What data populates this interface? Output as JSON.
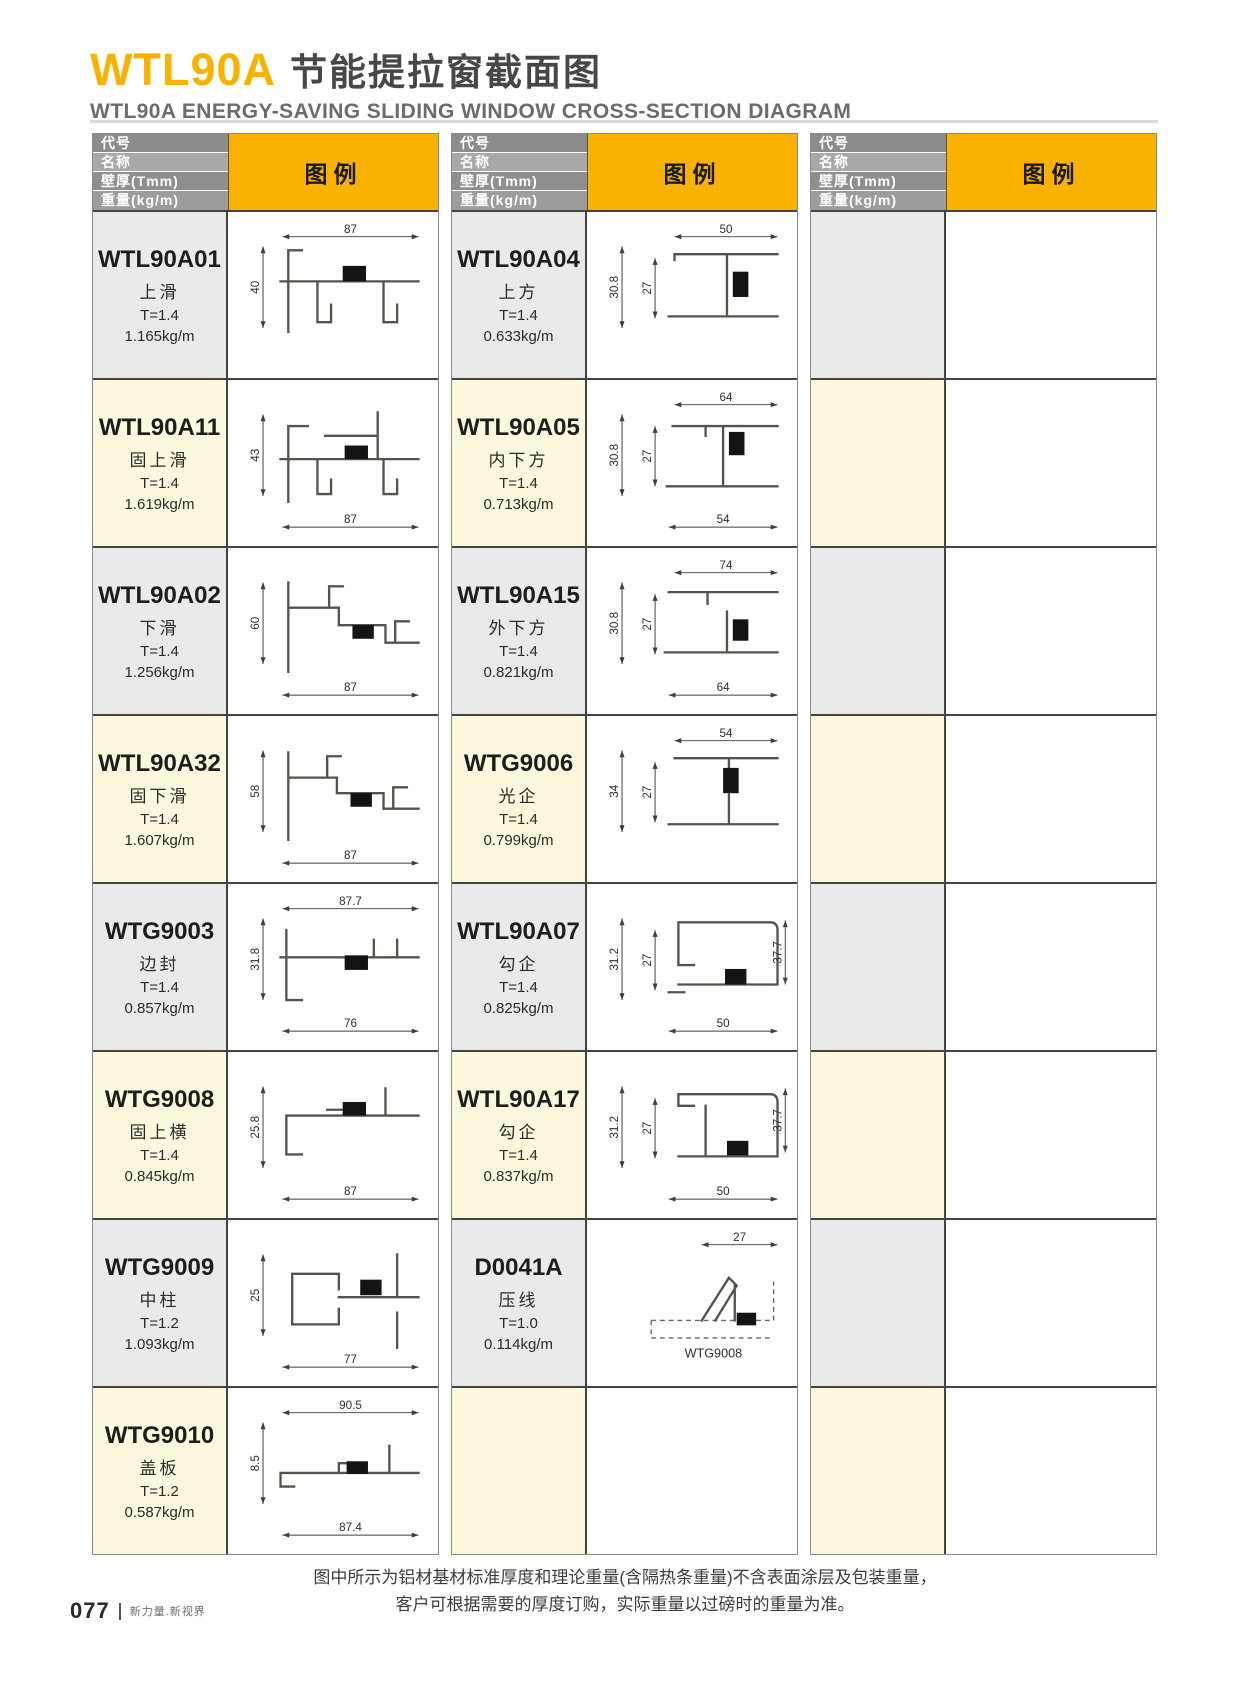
{
  "page": {
    "title_code": "WTL90A",
    "title_cn": "节能提拉窗截面图",
    "subtitle": "WTL90A ENERGY-SAVING SLIDING WINDOW CROSS-SECTION DIAGRAM",
    "footer_note_line1": "图中所示为铝材基材标准厚度和理论重量(含隔热条重量)不含表面涂层及包装重量，",
    "footer_note_line2": "客户可根据需要的厚度订购，实际重量以过磅时的重量为准。",
    "page_number": "077",
    "page_tagline": "新力量.新视界"
  },
  "colors": {
    "accent": "#F9B200",
    "header_grays": [
      "#8C8C8C",
      "#A8A8A8",
      "#8F8F8F",
      "#9C9C9C"
    ],
    "row_gray": "#EAEAEB",
    "row_cream": "#FBF8DD"
  },
  "table_header": {
    "labels": [
      "代号",
      "名称",
      "壁厚(Tmm)",
      "重量(kg/m)"
    ],
    "legend": "图例"
  },
  "tables": [
    {
      "rows": [
        {
          "code": "WTL90A01",
          "name": "上滑",
          "thickness": "T=1.4",
          "weight": "1.165kg/m",
          "diagram": {
            "top": "87",
            "left": "40",
            "sketch": "M60,36 h14 M60,36 v84 M52,68 h142 M90,68 v42 h14 v-18 M158,68 v42 h14 v-18",
            "block": [
              116,
              52,
              24,
              16
            ]
          }
        },
        {
          "code": "WTL90A11",
          "name": "固上滑",
          "thickness": "T=1.4",
          "weight": "1.619kg/m",
          "diagram": {
            "left": "43",
            "bottom": "87",
            "sketch": "M60,44 h20 M60,44 v78 M52,78 h142 M152,30 v48 M98,54 h54 M90,78 v36 h14 v-15 M158,78 v36 h14 v-15",
            "block": [
              118,
              64,
              24,
              14
            ]
          }
        },
        {
          "code": "WTL90A02",
          "name": "下滑",
          "thickness": "T=1.4",
          "weight": "1.256kg/m",
          "diagram": {
            "left": "60",
            "bottom": "87",
            "sketch": "M60,32 v92 M60,58 h52 v18 h48 v18 h34 M102,58 v-22 h14 M170,94 v-22 h14",
            "block": [
              126,
              76,
              22,
              14
            ]
          }
        },
        {
          "code": "WTL90A32",
          "name": "固下滑",
          "thickness": "T=1.4",
          "weight": "1.607kg/m",
          "diagram": {
            "left": "58",
            "bottom": "87",
            "sketch": "M60,34 v90 M60,60 h50 v16 h48 v16 h36 M100,60 v-22 h14 M168,92 v-22 h14",
            "block": [
              124,
              76,
              22,
              14
            ]
          }
        },
        {
          "code": "WTG9003",
          "name": "边封",
          "thickness": "T=1.4",
          "weight": "0.857kg/m",
          "diagram": {
            "top": "87.7",
            "left": "31.8",
            "bottom": "76",
            "sketch": "M58,44 v72 h16 M52,72 h142 M148,72 v-18 M172,72 v-18",
            "block": [
              118,
              70,
              24,
              15
            ]
          }
        },
        {
          "code": "WTG9008",
          "name": "固上横",
          "thickness": "T=1.4",
          "weight": "0.845kg/m",
          "diagram": {
            "left": "25.8",
            "bottom": "87",
            "sketch": "M58,62 h136 M58,62 v40 h16 M100,56 h18 M160,34 v28",
            "block": [
              116,
              48,
              24,
              14
            ]
          }
        },
        {
          "code": "WTG9009",
          "name": "中柱",
          "thickness": "T=1.2",
          "weight": "1.093kg/m",
          "diagram": {
            "left": "25",
            "bottom": "77",
            "sketch": "M64,52 h48 v16 M64,52 v52 h48 v-16 M112,76 h82 M172,32 v44 M172,92 v36",
            "block": [
              134,
              58,
              22,
              16
            ]
          }
        },
        {
          "code": "WTG9010",
          "name": "盖板",
          "thickness": "T=1.2",
          "weight": "0.587kg/m",
          "diagram": {
            "top": "90.5",
            "left": "8.5",
            "bottom": "87.4",
            "sketch": "M52,84 h142 M52,84 v14 h14 M112,84 v-10 h22 M164,56 v28",
            "block": [
              120,
              72,
              22,
              13
            ]
          }
        }
      ]
    },
    {
      "rows": [
        {
          "code": "WTL90A04",
          "name": "上方",
          "thickness": "T=1.4",
          "weight": "0.633kg/m",
          "diagram": {
            "top": "50",
            "left": "30.8",
            "left2": "27",
            "sketch": "M88,40 h106 M88,40 v6 M82,104 h112 M142,40 v64",
            "block": [
              148,
              58,
              16,
              26
            ]
          }
        },
        {
          "code": "WTL90A05",
          "name": "内下方",
          "thickness": "T=1.4",
          "weight": "0.713kg/m",
          "diagram": {
            "top": "64",
            "left": "30.8",
            "left2": "27",
            "bottom": "54",
            "sketch": "M86,44 h108 M80,106 h114 M138,44 v62 M120,44 v10",
            "block": [
              144,
              50,
              16,
              24
            ]
          }
        },
        {
          "code": "WTL90A15",
          "name": "外下方",
          "thickness": "T=1.4",
          "weight": "0.821kg/m",
          "diagram": {
            "top": "74",
            "left": "30.8",
            "left2": "27",
            "bottom": "64",
            "sketch": "M82,42 h112 M78,104 h116 M142,62 v42 M122,42 v12",
            "block": [
              148,
              70,
              16,
              22
            ]
          }
        },
        {
          "code": "WTG9006",
          "name": "光企",
          "thickness": "T=1.4",
          "weight": "0.799kg/m",
          "diagram": {
            "top": "54",
            "left": "34",
            "left2": "27",
            "sketch": "M88,40 h106 M82,108 h112 M144,40 v68",
            "block": [
              138,
              50,
              16,
              26
            ]
          }
        },
        {
          "code": "WTL90A07",
          "name": "勾企",
          "thickness": "T=1.4",
          "weight": "0.825kg/m",
          "diagram": {
            "left": "31.2",
            "left2": "27",
            "right": "37.7",
            "bottom": "50",
            "sketch": "M92,36 h94 q8,0 8,8 v56 M92,36 v44 h16 M92,100 h102 M82,108 h16",
            "block": [
              140,
              84,
              22,
              16
            ]
          }
        },
        {
          "code": "WTL90A17",
          "name": "勾企",
          "thickness": "T=1.4",
          "weight": "0.837kg/m",
          "diagram": {
            "left": "31.2",
            "left2": "27",
            "right": "37.7",
            "bottom": "50",
            "sketch": "M92,40 h94 q8,0 8,8 v56 M92,40 v12 h16 M92,104 h102 M120,52 v52",
            "block": [
              142,
              88,
              22,
              15
            ]
          }
        },
        {
          "code": "D0041A",
          "name": "压线",
          "thickness": "T=1.0",
          "weight": "0.114kg/m",
          "diagram": {
            "top": "27",
            "note": "WTG9008",
            "sketch": "M116,100 l28,-44 l8,8 l-22,36 M150,64 v36",
            "dashed": "M64,100 h126 M64,100 v18 M64,118 h126 M190,100 v-40",
            "block": [
              152,
              92,
              20,
              13
            ]
          }
        },
        {}
      ]
    },
    {
      "rows": [
        {},
        {},
        {},
        {},
        {},
        {},
        {},
        {}
      ]
    }
  ]
}
